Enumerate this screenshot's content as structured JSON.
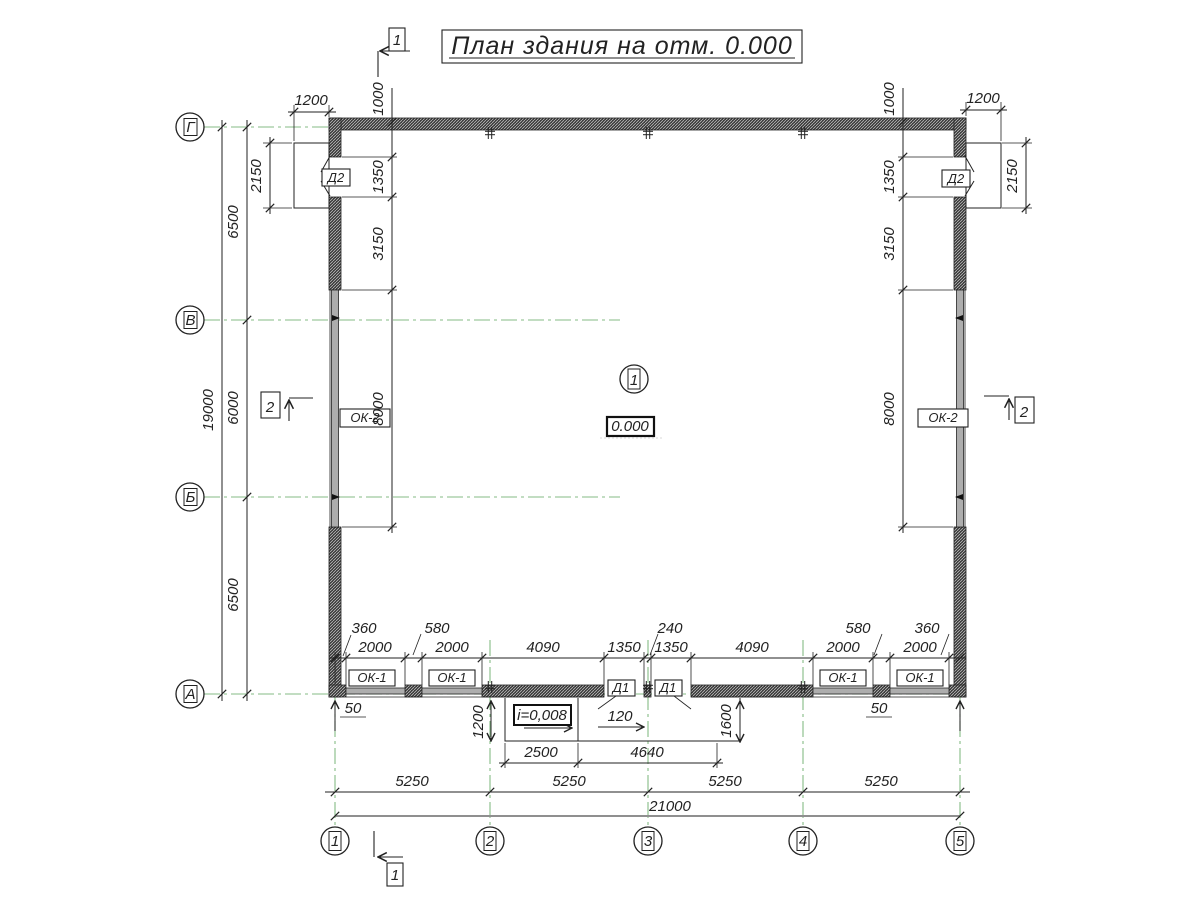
{
  "title": "План здания на отм. 0.000",
  "axes": {
    "rows": [
      "Г",
      "В",
      "Б",
      "А"
    ],
    "cols": [
      "1",
      "2",
      "3",
      "4",
      "5"
    ]
  },
  "room": {
    "number": "1",
    "elevation": "0.000"
  },
  "slope_label": "i=0,008",
  "component_labels": {
    "window1": "ОК-1",
    "window2": "ОК-2",
    "door1": "Д1",
    "door2": "Д2"
  },
  "section_marks": {
    "s1": "1",
    "s2": "2"
  },
  "dims": {
    "overall_width": "21000",
    "overall_height": "19000",
    "axis_spacing": [
      "5250",
      "5250",
      "5250",
      "5250"
    ],
    "row_spacing": [
      "6500",
      "6000",
      "6500"
    ],
    "door2_leaf_width": "1200",
    "door2_height": "2150",
    "door2_offset": "1000",
    "door2_opening": "1350",
    "side_pier": "3150",
    "side_window": "8000",
    "bottom_openings": [
      "2000",
      "2000",
      "4090",
      "1350",
      "1350",
      "4090",
      "2000",
      "2000"
    ],
    "bottom_piers": [
      "360",
      "580",
      "240",
      "580",
      "360"
    ],
    "pier_half": "120",
    "apron_depth1": "1200",
    "apron_depth2": "1600",
    "apron_w1": "2500",
    "apron_w2": "4640",
    "edge_offset": "50"
  },
  "colors": {
    "axis_green": "#85bb85",
    "line": "#222222",
    "wall": "#3d3d3d"
  }
}
